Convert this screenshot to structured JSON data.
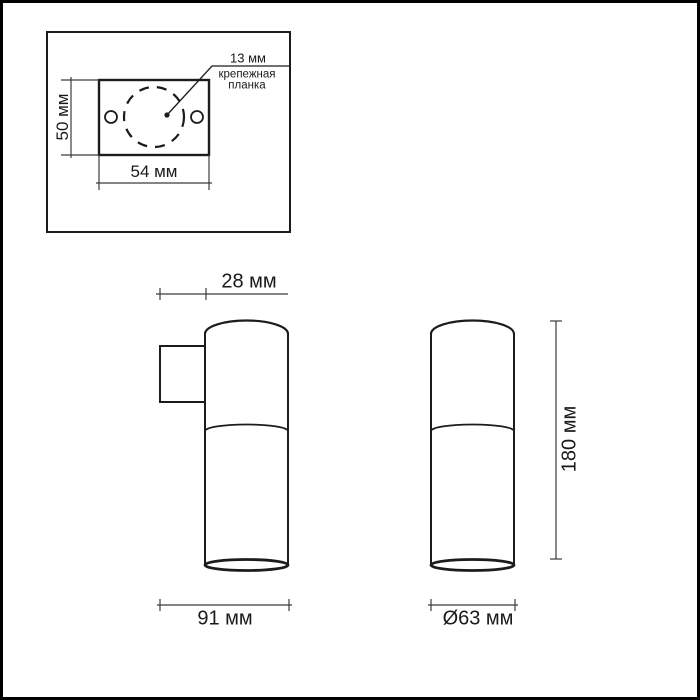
{
  "drawing": {
    "kind": "technical dimensional drawing of a cylindrical wall spot light",
    "units": "мм"
  },
  "colors": {
    "background": "#ffffff",
    "frame_border": "#000000",
    "outline_line": "#1c1c1c",
    "dimension_line": "#3c3c3c",
    "text": "#1a1a1a"
  },
  "mounting_plate_inset": {
    "height_dimension": "50 мм",
    "width_dimension": "54 мм",
    "circle_dimension": "13 мм",
    "callout_label": "крепежная\nпланка",
    "height_mm": 50,
    "width_mm": 54,
    "circle_mm": 13
  },
  "side_view": {
    "bracket_depth_dimension": "28 мм",
    "overall_depth_dimension": "91 мм",
    "bracket_depth_mm": 28,
    "overall_depth_mm": 91
  },
  "front_view": {
    "height_dimension": "180 мм",
    "diameter_dimension": "Ø63 мм",
    "height_mm": 180,
    "diameter_mm": 63
  }
}
